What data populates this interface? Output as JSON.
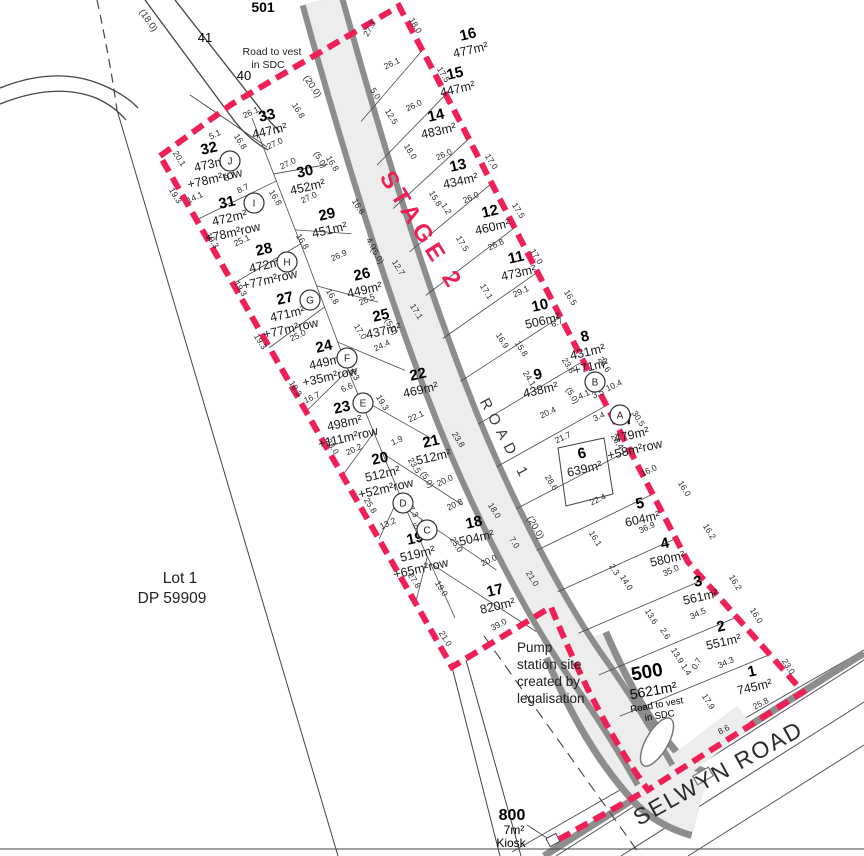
{
  "colors": {
    "boundary_red": "#ee2055",
    "road_fill": "#ededed",
    "kerb": "#8d8d8d",
    "line": "#3c3c3c"
  },
  "labels": {
    "stage2": "STAGE 2",
    "road1": "ROAD 1",
    "selwyn_road": "SELWYN ROAD",
    "lot1_dp_line1": "Lot 1",
    "lot1_dp_line2": "DP 59909",
    "pump_line1": "Pump",
    "pump_line2": "station site",
    "pump_line3": "created by",
    "pump_line4": "legalisation",
    "lot501_num": "501",
    "lot501_note1": "Road to vest",
    "lot501_note2": "in SDC",
    "lot500_num": "500",
    "lot500_area": "5621m²",
    "lot500_note1": "Road to vest",
    "lot500_note2": "in SDC",
    "lot800_num": "800",
    "lot800_area": "7m²",
    "lot800_note": "Kiosk",
    "lot40": "40",
    "lot41": "41",
    "road_width_18": "(18.0)",
    "road_width_20a": "(20.0)",
    "road_width_20b": "(20.0)"
  },
  "lots": [
    {
      "n": "1",
      "lines": [
        "745m²"
      ],
      "x": 753,
      "y": 676,
      "rot": -13
    },
    {
      "n": "2",
      "lines": [
        "551m²"
      ],
      "x": 722,
      "y": 631,
      "rot": -13
    },
    {
      "n": "3",
      "lines": [
        "561m²"
      ],
      "x": 699,
      "y": 586,
      "rot": -13
    },
    {
      "n": "4",
      "lines": [
        "580m²"
      ],
      "x": 666,
      "y": 548,
      "rot": -13
    },
    {
      "n": "5",
      "lines": [
        "604m²"
      ],
      "x": 641,
      "y": 508,
      "rot": -13
    },
    {
      "n": "6",
      "lines": [
        "639m²"
      ],
      "x": 583,
      "y": 458,
      "rot": -13
    },
    {
      "n": "7",
      "lines": [
        "479m²",
        "+58m²row"
      ],
      "x": 630,
      "y": 424,
      "rot": -13
    },
    {
      "n": "8",
      "lines": [
        "431m²",
        "+71m²",
        "row"
      ],
      "x": 586,
      "y": 341,
      "rot": -13
    },
    {
      "n": "9",
      "lines": [
        "438m²"
      ],
      "x": 539,
      "y": 379,
      "rot": -13
    },
    {
      "n": "10",
      "lines": [
        "506m²"
      ],
      "x": 541,
      "y": 310,
      "rot": -13
    },
    {
      "n": "11",
      "lines": [
        "473m²"
      ],
      "x": 517,
      "y": 262,
      "rot": -13
    },
    {
      "n": "12",
      "lines": [
        "460m²"
      ],
      "x": 491,
      "y": 216,
      "rot": -13
    },
    {
      "n": "13",
      "lines": [
        "434m²"
      ],
      "x": 459,
      "y": 170,
      "rot": -13
    },
    {
      "n": "14",
      "lines": [
        "483m²"
      ],
      "x": 437,
      "y": 120,
      "rot": -13
    },
    {
      "n": "15",
      "lines": [
        "447m²"
      ],
      "x": 456,
      "y": 78,
      "rot": -13
    },
    {
      "n": "16",
      "lines": [
        "477m²"
      ],
      "x": 469,
      "y": 39,
      "rot": -13
    },
    {
      "n": "17",
      "lines": [
        "820m²"
      ],
      "x": 496,
      "y": 595,
      "rot": -13
    },
    {
      "n": "18",
      "lines": [
        "504m²"
      ],
      "x": 475,
      "y": 527,
      "rot": -13
    },
    {
      "n": "19",
      "lines": [
        "519m²",
        "+65m²row"
      ],
      "x": 416,
      "y": 543,
      "rot": -13
    },
    {
      "n": "20",
      "lines": [
        "512m²",
        "+52m²row"
      ],
      "x": 381,
      "y": 463,
      "rot": -13
    },
    {
      "n": "21",
      "lines": [
        "512m²"
      ],
      "x": 432,
      "y": 446,
      "rot": -13
    },
    {
      "n": "22",
      "lines": [
        "469m²"
      ],
      "x": 419,
      "y": 379,
      "rot": -13
    },
    {
      "n": "23",
      "lines": [
        "498m²",
        "+111m²row"
      ],
      "x": 343,
      "y": 412,
      "rot": -13
    },
    {
      "n": "24",
      "lines": [
        "449m²",
        "+35m²row"
      ],
      "x": 325,
      "y": 351,
      "rot": -13
    },
    {
      "n": "25",
      "lines": [
        "437m²"
      ],
      "x": 382,
      "y": 320,
      "rot": -13
    },
    {
      "n": "26",
      "lines": [
        "449m²"
      ],
      "x": 363,
      "y": 279,
      "rot": -13
    },
    {
      "n": "27",
      "lines": [
        "471m²",
        "+77m²row"
      ],
      "x": 286,
      "y": 303,
      "rot": -13
    },
    {
      "n": "28",
      "lines": [
        "472m²",
        "+77m²row"
      ],
      "x": 265,
      "y": 254,
      "rot": -13
    },
    {
      "n": "29",
      "lines": [
        "451m²"
      ],
      "x": 328,
      "y": 219,
      "rot": -13
    },
    {
      "n": "30",
      "lines": [
        "452m²"
      ],
      "x": 306,
      "y": 176,
      "rot": -13
    },
    {
      "n": "31",
      "lines": [
        "472m²",
        "+78m²row"
      ],
      "x": 228,
      "y": 207,
      "rot": -13
    },
    {
      "n": "32",
      "lines": [
        "473m²",
        "+78m²row"
      ],
      "x": 210,
      "y": 153,
      "rot": -13
    },
    {
      "n": "33",
      "lines": [
        "447m²"
      ],
      "x": 268,
      "y": 120,
      "rot": -13
    }
  ],
  "easement_markers": [
    {
      "letter": "A",
      "x": 620,
      "y": 415
    },
    {
      "letter": "B",
      "x": 595,
      "y": 382
    },
    {
      "letter": "C",
      "x": 427,
      "y": 530
    },
    {
      "letter": "D",
      "x": 403,
      "y": 503
    },
    {
      "letter": "E",
      "x": 363,
      "y": 403
    },
    {
      "letter": "F",
      "x": 347,
      "y": 358
    },
    {
      "letter": "G",
      "x": 310,
      "y": 300
    },
    {
      "letter": "H",
      "x": 287,
      "y": 262
    },
    {
      "letter": "I",
      "x": 254,
      "y": 203
    },
    {
      "letter": "J",
      "x": 230,
      "y": 161
    }
  ],
  "dims": [
    {
      "t": "27.3",
      "x": 372,
      "y": 30,
      "r": -60
    },
    {
      "t": "18.0",
      "x": 413,
      "y": 27,
      "r": 58
    },
    {
      "t": "26.1",
      "x": 393,
      "y": 66,
      "r": -25
    },
    {
      "t": "17.5",
      "x": 441,
      "y": 76,
      "r": 58
    },
    {
      "t": "5.0",
      "x": 373,
      "y": 95,
      "r": 58
    },
    {
      "t": "12.5",
      "x": 389,
      "y": 118,
      "r": 58
    },
    {
      "t": "16.8",
      "x": 296,
      "y": 112,
      "r": 58
    },
    {
      "t": "26.1",
      "x": 252,
      "y": 115,
      "r": -25
    },
    {
      "t": "5.1",
      "x": 216,
      "y": 137,
      "r": -25
    },
    {
      "t": "16.8",
      "x": 238,
      "y": 143,
      "r": 58
    },
    {
      "t": "27.0",
      "x": 276,
      "y": 146,
      "r": -25
    },
    {
      "t": "26.0",
      "x": 415,
      "y": 108,
      "r": -25
    },
    {
      "t": "18.0",
      "x": 408,
      "y": 153,
      "r": 58
    },
    {
      "t": "26.0",
      "x": 445,
      "y": 157,
      "r": -25
    },
    {
      "t": "17.0",
      "x": 489,
      "y": 163,
      "r": 58
    },
    {
      "t": "20.1",
      "x": 177,
      "y": 160,
      "r": 58
    },
    {
      "t": "8.7",
      "x": 231,
      "y": 179,
      "r": -25
    },
    {
      "t": "8.7",
      "x": 244,
      "y": 191,
      "r": -25
    },
    {
      "t": "27.0",
      "x": 289,
      "y": 166,
      "r": -25
    },
    {
      "t": "(5.0)",
      "x": 318,
      "y": 161,
      "r": 58
    },
    {
      "t": "16.8",
      "x": 330,
      "y": 165,
      "r": 58
    },
    {
      "t": "19.3",
      "x": 173,
      "y": 197,
      "r": 58
    },
    {
      "t": "14.1",
      "x": 196,
      "y": 200,
      "r": -25
    },
    {
      "t": "27.0",
      "x": 310,
      "y": 200,
      "r": -25
    },
    {
      "t": "16.8",
      "x": 273,
      "y": 199,
      "r": 58
    },
    {
      "t": "15.8",
      "x": 433,
      "y": 200,
      "r": 58
    },
    {
      "t": "1.2",
      "x": 444,
      "y": 210,
      "r": 58
    },
    {
      "t": "26.0",
      "x": 472,
      "y": 200,
      "r": -25
    },
    {
      "t": "17.5",
      "x": 516,
      "y": 212,
      "r": 58
    },
    {
      "t": "25.1",
      "x": 243,
      "y": 243,
      "r": -25
    },
    {
      "t": "19.3",
      "x": 210,
      "y": 242,
      "r": 58
    },
    {
      "t": "16.8",
      "x": 300,
      "y": 243,
      "r": 58
    },
    {
      "t": "26.9",
      "x": 340,
      "y": 258,
      "r": -25
    },
    {
      "t": "16.8",
      "x": 356,
      "y": 208,
      "r": 58
    },
    {
      "t": "17.5",
      "x": 460,
      "y": 245,
      "r": 58
    },
    {
      "t": "26.8",
      "x": 497,
      "y": 247,
      "r": -25
    },
    {
      "t": "17.0",
      "x": 534,
      "y": 258,
      "r": 58
    },
    {
      "t": "(5.0)",
      "x": 375,
      "y": 257,
      "r": 58
    },
    {
      "t": "4.0",
      "x": 369,
      "y": 245,
      "r": 58
    },
    {
      "t": "12.7",
      "x": 396,
      "y": 269,
      "r": 58
    },
    {
      "t": "19.3",
      "x": 238,
      "y": 290,
      "r": 58
    },
    {
      "t": "16.8",
      "x": 330,
      "y": 298,
      "r": 58
    },
    {
      "t": "26.5",
      "x": 368,
      "y": 302,
      "r": -25
    },
    {
      "t": "17.1",
      "x": 414,
      "y": 313,
      "r": 58
    },
    {
      "t": "29.1",
      "x": 522,
      "y": 294,
      "r": -25
    },
    {
      "t": "16.5",
      "x": 568,
      "y": 299,
      "r": 58
    },
    {
      "t": "17.1",
      "x": 484,
      "y": 293,
      "r": 58
    },
    {
      "t": "25.0",
      "x": 299,
      "y": 338,
      "r": -25
    },
    {
      "t": "17.0",
      "x": 358,
      "y": 333,
      "r": 58
    },
    {
      "t": "24.4",
      "x": 383,
      "y": 348,
      "r": -25
    },
    {
      "t": "(5.0)",
      "x": 389,
      "y": 328,
      "r": 58
    },
    {
      "t": "16.9",
      "x": 500,
      "y": 342,
      "r": 58
    },
    {
      "t": "15.8",
      "x": 519,
      "y": 350,
      "r": 58
    },
    {
      "t": "6.7",
      "x": 558,
      "y": 325,
      "r": -25
    },
    {
      "t": "23.8",
      "x": 566,
      "y": 367,
      "r": 58
    },
    {
      "t": "(5.0)",
      "x": 570,
      "y": 397,
      "r": 58
    },
    {
      "t": "26.6",
      "x": 602,
      "y": 366,
      "r": 58
    },
    {
      "t": "10.4",
      "x": 615,
      "y": 388,
      "r": -25
    },
    {
      "t": "19.3",
      "x": 258,
      "y": 343,
      "r": 58
    },
    {
      "t": "18.3",
      "x": 293,
      "y": 390,
      "r": 58
    },
    {
      "t": "6.6",
      "x": 348,
      "y": 390,
      "r": -25
    },
    {
      "t": "8.3",
      "x": 352,
      "y": 376,
      "r": 58
    },
    {
      "t": "24.1",
      "x": 527,
      "y": 380,
      "r": 58
    },
    {
      "t": "20.4",
      "x": 549,
      "y": 415,
      "r": -25
    },
    {
      "t": "4.1",
      "x": 585,
      "y": 397,
      "r": -25
    },
    {
      "t": "3.5",
      "x": 599,
      "y": 396,
      "r": -25
    },
    {
      "t": "3.4",
      "x": 600,
      "y": 419,
      "r": -25
    },
    {
      "t": "30.5",
      "x": 636,
      "y": 420,
      "r": 58
    },
    {
      "t": "16.7",
      "x": 313,
      "y": 400,
      "r": -25
    },
    {
      "t": "19.3",
      "x": 380,
      "y": 404,
      "r": 58
    },
    {
      "t": "22.1",
      "x": 417,
      "y": 419,
      "r": -25
    },
    {
      "t": "1.9",
      "x": 398,
      "y": 443,
      "r": -25
    },
    {
      "t": "23.8",
      "x": 456,
      "y": 441,
      "r": 58
    },
    {
      "t": "23.0",
      "x": 330,
      "y": 448,
      "r": 58
    },
    {
      "t": "20.2",
      "x": 355,
      "y": 452,
      "r": -25
    },
    {
      "t": "23.5",
      "x": 412,
      "y": 467,
      "r": 58
    },
    {
      "t": "(5.0)",
      "x": 425,
      "y": 481,
      "r": 58
    },
    {
      "t": "20.0",
      "x": 446,
      "y": 483,
      "r": -25
    },
    {
      "t": "21.7",
      "x": 564,
      "y": 440,
      "r": -25
    },
    {
      "t": "28.4",
      "x": 615,
      "y": 443,
      "r": 58
    },
    {
      "t": "16.0",
      "x": 650,
      "y": 473,
      "r": -25
    },
    {
      "t": "16.0",
      "x": 682,
      "y": 490,
      "r": 58
    },
    {
      "t": "28.6",
      "x": 549,
      "y": 484,
      "r": 58
    },
    {
      "t": "22.4",
      "x": 599,
      "y": 502,
      "r": -25
    },
    {
      "t": "25.8",
      "x": 368,
      "y": 507,
      "r": 58
    },
    {
      "t": "20.8",
      "x": 456,
      "y": 507,
      "r": -25
    },
    {
      "t": "18.0",
      "x": 492,
      "y": 512,
      "r": 58
    },
    {
      "t": "7.3",
      "x": 411,
      "y": 513,
      "r": 58
    },
    {
      "t": "6.4",
      "x": 420,
      "y": 527,
      "r": -25
    },
    {
      "t": "13.2",
      "x": 389,
      "y": 526,
      "r": -25
    },
    {
      "t": "25.0",
      "x": 454,
      "y": 546,
      "r": 58
    },
    {
      "t": "7.0",
      "x": 512,
      "y": 544,
      "r": 58
    },
    {
      "t": "20.0",
      "x": 490,
      "y": 563,
      "r": -25
    },
    {
      "t": "21.0",
      "x": 530,
      "y": 580,
      "r": 58
    },
    {
      "t": "36.9",
      "x": 648,
      "y": 530,
      "r": -25
    },
    {
      "t": "16.2",
      "x": 707,
      "y": 533,
      "r": 58
    },
    {
      "t": "16.1",
      "x": 593,
      "y": 540,
      "r": 58
    },
    {
      "t": "35.0",
      "x": 672,
      "y": 573,
      "r": -25
    },
    {
      "t": "16.2",
      "x": 733,
      "y": 584,
      "r": 58
    },
    {
      "t": "2.3",
      "x": 612,
      "y": 571,
      "r": 58
    },
    {
      "t": "14.0",
      "x": 624,
      "y": 584,
      "r": 58
    },
    {
      "t": "27.8",
      "x": 412,
      "y": 582,
      "r": 58
    },
    {
      "t": "19.0",
      "x": 439,
      "y": 590,
      "r": 58
    },
    {
      "t": "13.6",
      "x": 649,
      "y": 618,
      "r": 58
    },
    {
      "t": "34.5",
      "x": 699,
      "y": 616,
      "r": -25
    },
    {
      "t": "16.0",
      "x": 754,
      "y": 617,
      "r": 58
    },
    {
      "t": "21.0",
      "x": 443,
      "y": 640,
      "r": 58
    },
    {
      "t": "39.0",
      "x": 500,
      "y": 627,
      "r": -28
    },
    {
      "t": "2.6",
      "x": 663,
      "y": 635,
      "r": 58
    },
    {
      "t": "13.9",
      "x": 675,
      "y": 657,
      "r": 58
    },
    {
      "t": "1.4",
      "x": 684,
      "y": 671,
      "r": 58
    },
    {
      "t": "0.7",
      "x": 699,
      "y": 665,
      "r": -60
    },
    {
      "t": "34.3",
      "x": 727,
      "y": 665,
      "r": -25
    },
    {
      "t": "23.0",
      "x": 786,
      "y": 668,
      "r": 58
    },
    {
      "t": "17.9",
      "x": 706,
      "y": 703,
      "r": 58
    },
    {
      "t": "25.8",
      "x": 762,
      "y": 706,
      "r": -27
    },
    {
      "t": "8.6",
      "x": 725,
      "y": 732,
      "r": -27
    }
  ]
}
